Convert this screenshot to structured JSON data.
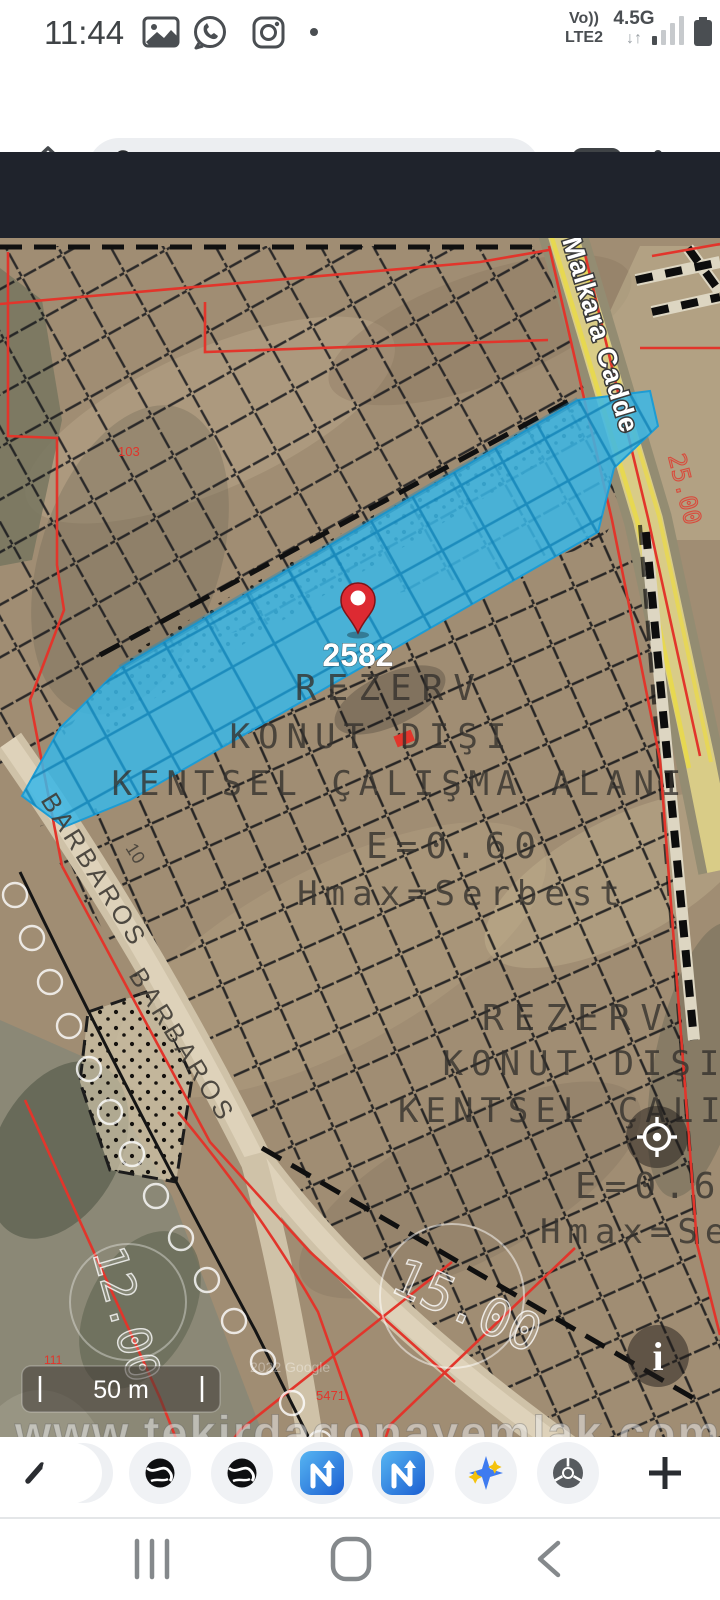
{
  "status_bar": {
    "time": "11:44",
    "volte": "Vo))",
    "network_sub": "LTE2",
    "network": "4.5G",
    "arrows": "↓↑"
  },
  "chrome_bar": {
    "url": "os.suleymanpasa.bel.tr:8080",
    "tab_count": "3"
  },
  "app_toolbar": {
    "search_value": "0/2582 bar",
    "checkbox_label": "Tam"
  },
  "map": {
    "pin_label": "2582",
    "zone_block_1": {
      "line1": "REZERV",
      "line2": "KONUT DIŞI",
      "line3": "KENTSEL ÇALIŞMA ALANI",
      "line4": "E=0.60",
      "line5": "Hmax=Serbest"
    },
    "zone_block_2": {
      "line1": "REZERV",
      "line2": "KONUT DIŞI",
      "line3": "KENTSEL ÇALIŞMA ALANI",
      "line4": "E=0.60",
      "line5": "Hmax=Serbest"
    },
    "street_1": "BARBAROS",
    "street_2": "BARBAROS",
    "street_3": "Malkara Cadde",
    "road_width_1": "12.00",
    "road_width_2": "15.00",
    "road_width_3": "25.00",
    "lot_number": "10",
    "parcel_no_1": "103",
    "parcel_no_2": "5471",
    "parcel_no_3": "111",
    "attribution": "2022 Google",
    "scale_label": "50 m",
    "watermark": "www.tekirdagonayemlak.com"
  }
}
